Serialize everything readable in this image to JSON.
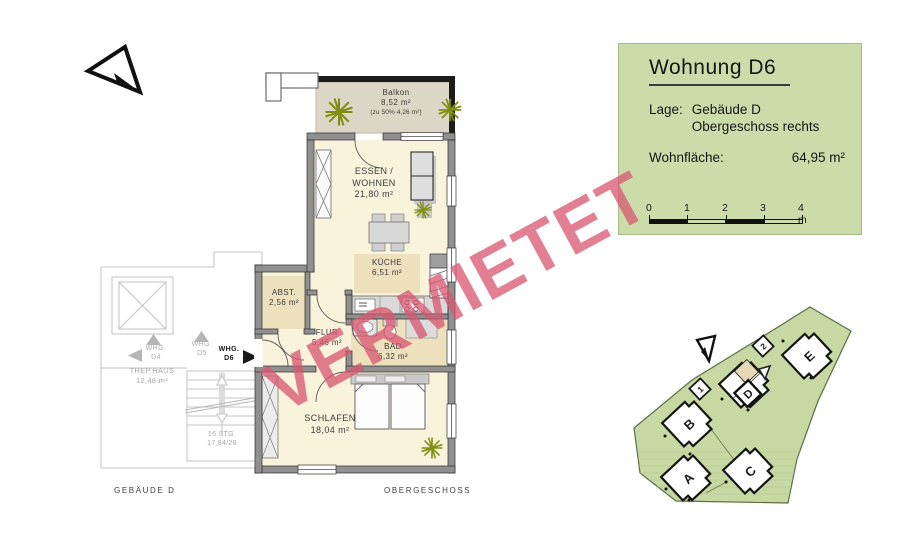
{
  "watermark": {
    "text": "VERMIETET"
  },
  "info_box": {
    "title": "Wohnung  D6",
    "location_label": "Lage:",
    "location_line1": "Gebäude D",
    "location_line2": "Obergeschoss rechts",
    "area_label": "Wohnfläche:",
    "area_value": "64,95 m²",
    "scale_ticks": {
      "t0": "0",
      "t1": "1",
      "t2": "2",
      "t3": "3",
      "t4": "4 m"
    }
  },
  "floor_plan": {
    "rooms": {
      "balkon": {
        "name": "Balkon",
        "area": "8,52 m²",
        "note": "(zu 50% 4,26 m²)"
      },
      "wohnen": {
        "line1": "ESSEN /",
        "line2": "WOHNEN",
        "area": "21,80 m²"
      },
      "kueche": {
        "name": "KÜCHE",
        "area": "6,51 m²"
      },
      "abst": {
        "name": "ABST.",
        "area": "2,56 m²"
      },
      "flur": {
        "name": "FLUR",
        "area": "5,46 m²"
      },
      "bad": {
        "name": "BAD",
        "area": "6,32 m²"
      },
      "schlafen": {
        "name": "SCHLAFEN",
        "area": "18,04 m²"
      }
    },
    "stairwell": {
      "trephaus_name": "TREP.HAUS",
      "trephaus_area": "12,48 m²",
      "stairs_line1": "16 STG.",
      "stairs_line2": "17,84/28",
      "whg_d4_l1": "WHG.",
      "whg_d4_l2": "D4",
      "whg_d5_l1": "WHG.",
      "whg_d5_l2": "D5",
      "whg_d6_l1": "WHG.",
      "whg_d6_l2": "D6"
    },
    "footer_left": "GEBÄUDE  D",
    "footer_right": "OBERGESCHOSS"
  },
  "site_plan": {
    "buildings": {
      "a": "A",
      "b": "B",
      "c": "C",
      "d": "D",
      "e": "E"
    },
    "markers": {
      "m1": "1",
      "m2": "2"
    }
  },
  "colors": {
    "info_box_bg": "#cbdcaa",
    "site_green": "#c7d8a3",
    "apartment_cream": "#faf3dc",
    "room_beige": "#ece0bd",
    "balcony_gray": "#dcd6c6",
    "wall_gray": "#909090",
    "watermark_pink": "#d95871",
    "plant_green": "#7f8f12"
  }
}
